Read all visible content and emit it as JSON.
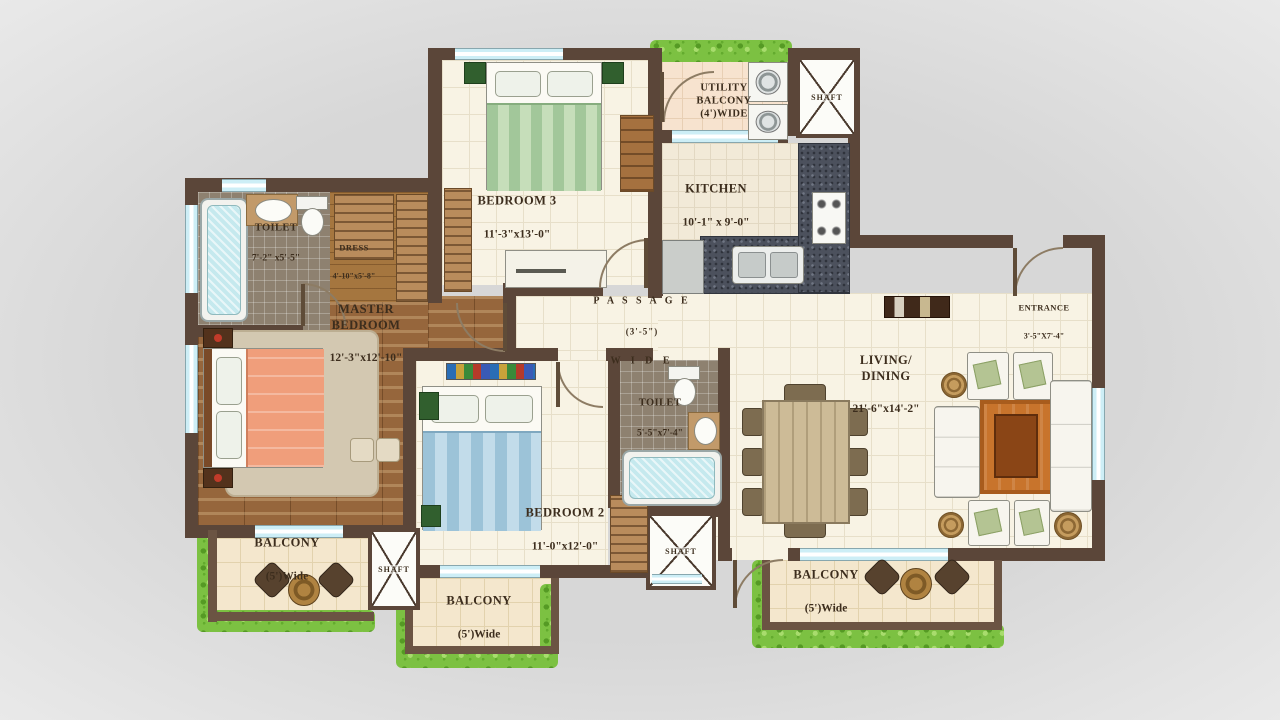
{
  "plan_title": "2BHK+ apartment floor plan",
  "colors": {
    "wall": "#5b4639",
    "floor_cream": "#f8f3e4",
    "wood": "#96663c",
    "window_blue": "#cdeef6",
    "greenery": "#7cc142",
    "granite": "#4c515d",
    "label_text": "#3c2d1d"
  },
  "rooms": {
    "bedroom3": {
      "name": "BEDROOM 3",
      "dims": "11'-3\"x13'-0\""
    },
    "kitchen": {
      "name": "KITCHEN",
      "dims": "10'-1\" x 9'-0\""
    },
    "utility_balcony": {
      "name": "UTILITY\nBALCONY\n(4')WIDE"
    },
    "toilet1": {
      "name": "TOILET",
      "dims": "7'-2\" x5'-5\""
    },
    "dress": {
      "name": "DRESS",
      "dims": "4'-10\"x5'-8\""
    },
    "master_bedroom": {
      "name": "MASTER\nBEDROOM",
      "dims": "12'-3\"x12'-10\""
    },
    "passage": {
      "name": "P A S S A G E",
      "dims": "(3'-5\")",
      "extra": "W I D E"
    },
    "toilet2": {
      "name": "TOILET",
      "dims": "5'-5\"x7'-4\""
    },
    "living_dining": {
      "name": "LIVING/\nDINING",
      "dims": "21'-6\"x14'-2\""
    },
    "entrance": {
      "name": "ENTRANCE",
      "dims": "3'-5\"X7'-4\""
    },
    "bedroom2": {
      "name": "BEDROOM 2",
      "dims": "11'-0\"x12'-0\""
    },
    "balcony_left": {
      "name": "BALCONY",
      "dims": "(5')Wide"
    },
    "balcony_mid": {
      "name": "BALCONY",
      "dims": "(5')Wide"
    },
    "balcony_right": {
      "name": "BALCONY",
      "dims": "(5')Wide"
    },
    "shaft_top": {
      "name": "SHAFT"
    },
    "shaft_left": {
      "name": "SHAFT"
    },
    "shaft_mid": {
      "name": "SHAFT"
    }
  }
}
